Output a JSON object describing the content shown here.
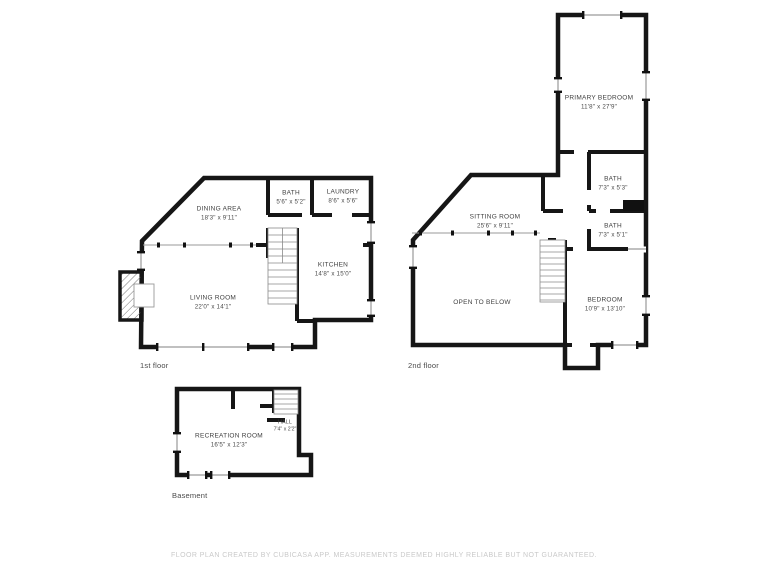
{
  "page": {
    "footer": "FLOOR PLAN CREATED BY CUBICASA APP. MEASUREMENTS DEEMED HIGHLY RELIABLE BUT NOT GUARANTEED."
  },
  "colors": {
    "wall": "#161616",
    "window_line": "#9a9a9a",
    "label_text": "#3f3f3f",
    "footer_text": "#c9c9c9",
    "background": "#ffffff"
  },
  "floors": {
    "first": {
      "label": "1st floor",
      "rooms": {
        "dining": {
          "name": "DINING AREA",
          "dims": "18'3\" x 9'11\""
        },
        "bath": {
          "name": "BATH",
          "dims": "5'6\" x 5'2\""
        },
        "laundry": {
          "name": "LAUNDRY",
          "dims": "8'6\" x 5'6\""
        },
        "kitchen": {
          "name": "KITCHEN",
          "dims": "14'8\" x 15'0\""
        },
        "living": {
          "name": "LIVING ROOM",
          "dims": "22'0\" x 14'1\""
        }
      }
    },
    "second": {
      "label": "2nd floor",
      "rooms": {
        "primary_bedroom": {
          "name": "PRIMARY BEDROOM",
          "dims": "11'8\" x 27'9\""
        },
        "bath_upper": {
          "name": "BATH",
          "dims": "7'3\" x 5'3\""
        },
        "bath_lower": {
          "name": "BATH",
          "dims": "7'3\" x 5'1\""
        },
        "sitting": {
          "name": "SITTING ROOM",
          "dims": "25'6\" x 9'11\""
        },
        "open_below": {
          "name": "OPEN TO BELOW",
          "dims": ""
        },
        "bedroom": {
          "name": "BEDROOM",
          "dims": "10'9\" x 13'10\""
        }
      }
    },
    "basement": {
      "label": "Basement",
      "rooms": {
        "recreation": {
          "name": "RECREATION ROOM",
          "dims": "16'5\" x 12'3\""
        },
        "hall": {
          "name": "HALL",
          "dims": "7'4\" x 2'2\""
        }
      }
    }
  }
}
